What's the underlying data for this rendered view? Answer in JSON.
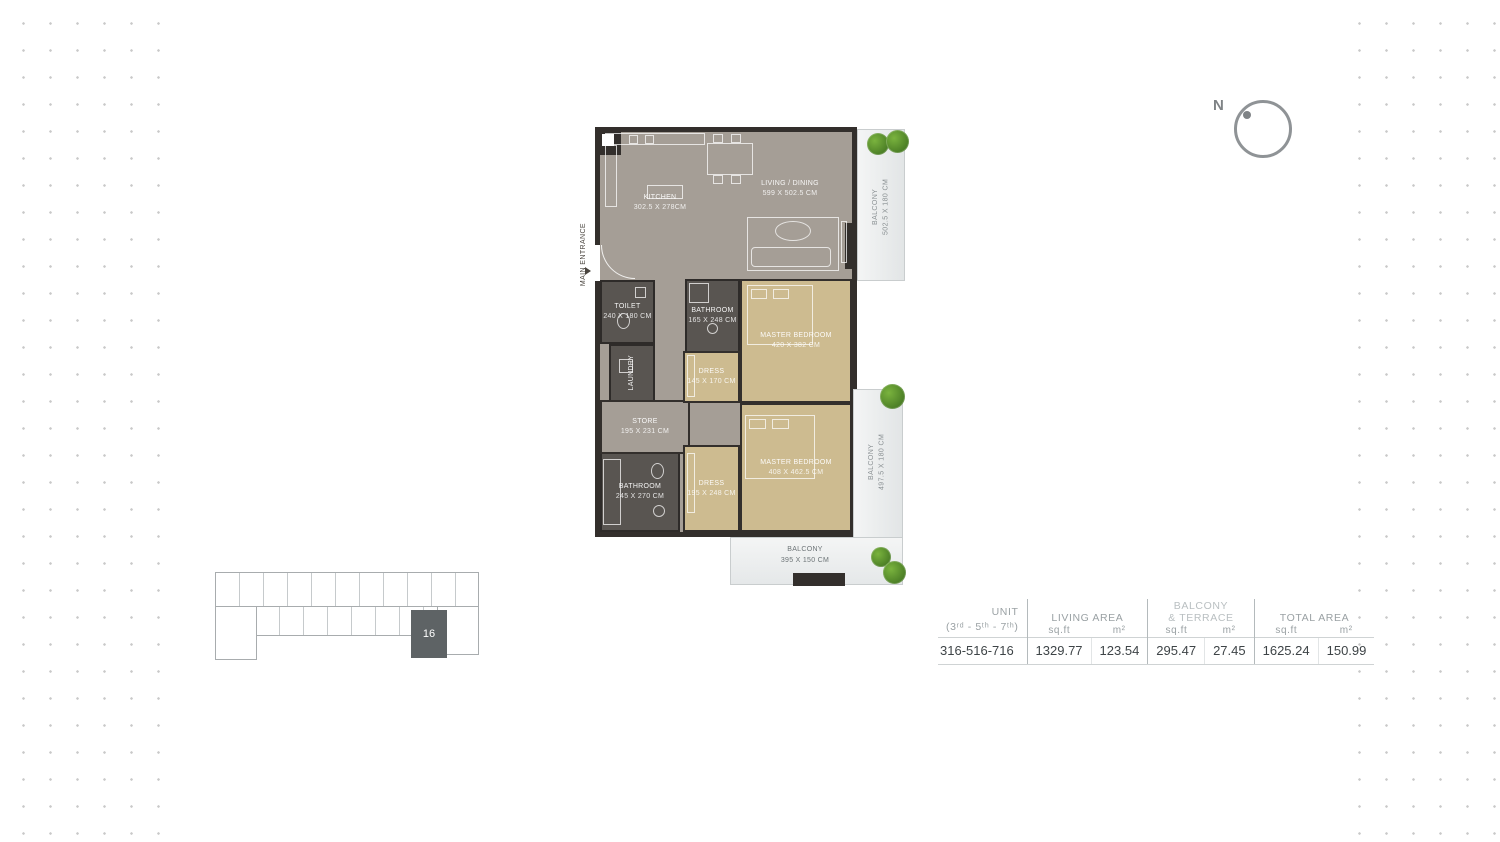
{
  "compass": {
    "north_label": "N"
  },
  "keyplan": {
    "unit_number": "16"
  },
  "floorplan": {
    "main_entrance_label": "MAIN ENTRANCE",
    "rooms": [
      {
        "id": "kitchen",
        "name": "KITCHEN",
        "dims": "302.5 x 278cm"
      },
      {
        "id": "living_dining",
        "name": "LIVING / DINING",
        "dims": "599 x 502.5 cm"
      },
      {
        "id": "balcony_top",
        "name": "BALCONY",
        "dims": "502.5 x 180 cm"
      },
      {
        "id": "toilet",
        "name": "TOILET",
        "dims": "240 x 180 cm"
      },
      {
        "id": "bathroom_upper",
        "name": "BATHROOM",
        "dims": "165 x 248 cm"
      },
      {
        "id": "laundry",
        "name": "LAUNDRY",
        "dims": ""
      },
      {
        "id": "dress_upper",
        "name": "DRESS",
        "dims": "145 x 170 cm"
      },
      {
        "id": "master_upper",
        "name": "MASTER BEDROOM",
        "dims": "420 x 382 cm"
      },
      {
        "id": "store",
        "name": "STORE",
        "dims": "195 x 231 cm"
      },
      {
        "id": "bathroom_lower",
        "name": "BATHROOM",
        "dims": "245 x 270 cm"
      },
      {
        "id": "dress_lower",
        "name": "DRESS",
        "dims": "195 x 248 cm"
      },
      {
        "id": "master_lower",
        "name": "MASTER BEDROOM",
        "dims": "408 x 462.5 cm"
      },
      {
        "id": "balcony_right",
        "name": "BALCONY",
        "dims": "497.5 x 180 cm"
      },
      {
        "id": "balcony_bottom",
        "name": "BALCONY",
        "dims": "395 x 150 cm"
      }
    ]
  },
  "table": {
    "unit_header": "UNIT",
    "unit_subheader": "(3ʳᵈ - 5ᵗʰ - 7ᵗʰ)",
    "living_area_header": "LIVING AREA",
    "balcony_header": "BALCONY\n& TERRACE",
    "total_area_header": "TOTAL AREA",
    "sqft_label": "sq.ft",
    "m2_label": "m²",
    "row": {
      "unit": "316-516-716",
      "living_sqft": "1329.77",
      "living_m2": "123.54",
      "balcony_sqft": "295.47",
      "balcony_m2": "27.45",
      "total_sqft": "1625.24",
      "total_m2": "150.99"
    }
  },
  "colors": {
    "wall": "#332f2c",
    "floor_gray": "#a59e96",
    "floor_tan": "#cdbb90",
    "floor_dark": "#595551",
    "plant_green": "#4c7f26",
    "keyplan_highlight": "#5e6365",
    "table_text": "#3e4447",
    "table_header": "#9aa1a4",
    "dot": "#c9c9c9"
  }
}
